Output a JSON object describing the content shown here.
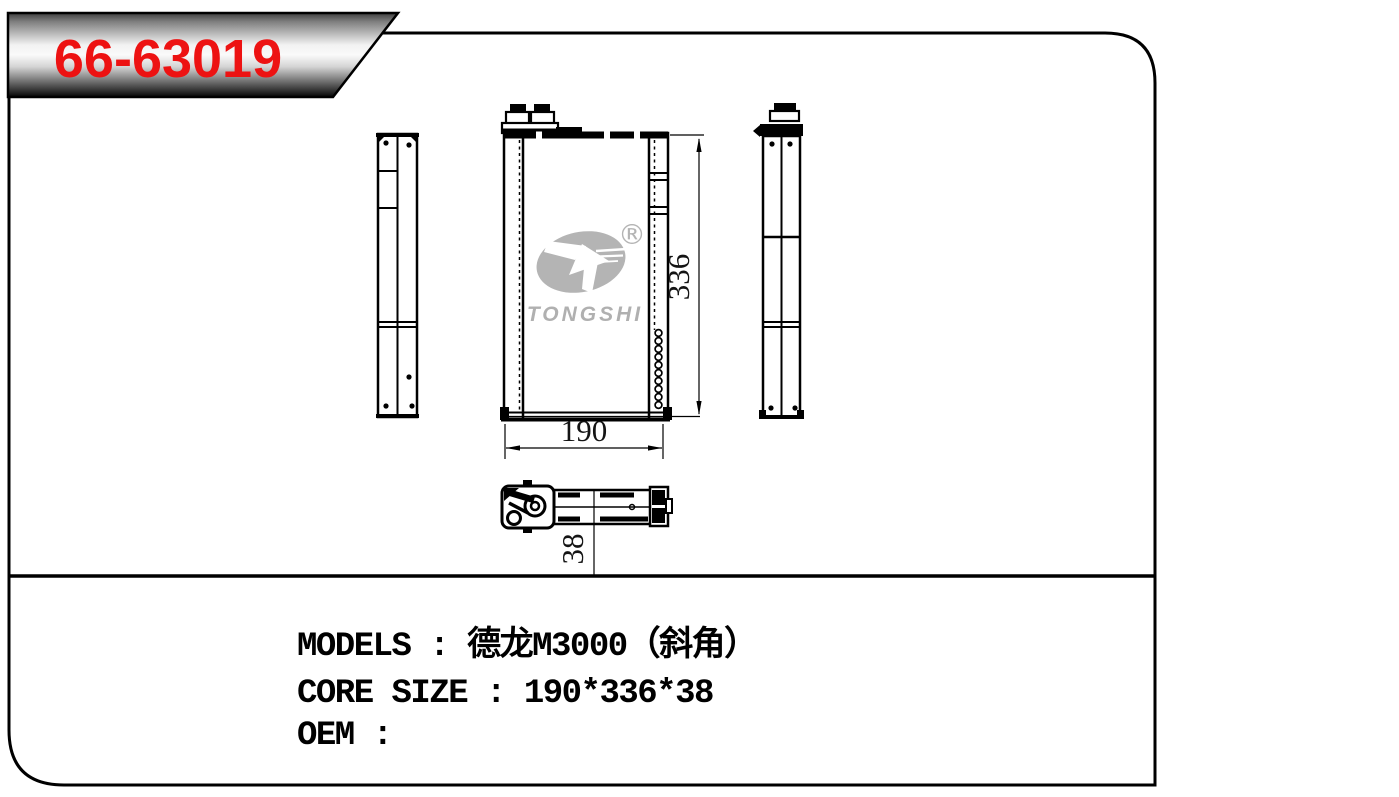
{
  "badge": {
    "part_number": "66-63019"
  },
  "logo": {
    "name": "TONGSHI",
    "registered_mark": "®"
  },
  "dimensions": {
    "width": "190",
    "height": "336",
    "depth": "38"
  },
  "spec_lines": [
    {
      "label": "MODELS",
      "value": "德龙M3000（斜角）",
      "text": "MODELS : 德龙M3000（斜角）"
    },
    {
      "label": "CORE SIZE",
      "value": "190*336*38",
      "text": "CORE SIZE : 190*336*38"
    },
    {
      "label": "OEM",
      "value": "",
      "text": "OEM :"
    }
  ],
  "colors": {
    "part_number_red": "#ed1212",
    "logo_gray": "#b4b4b4",
    "line_black": "#000000",
    "badge_metal_light": "#f8f8f8",
    "badge_metal_dark": "#0a0a0a"
  }
}
